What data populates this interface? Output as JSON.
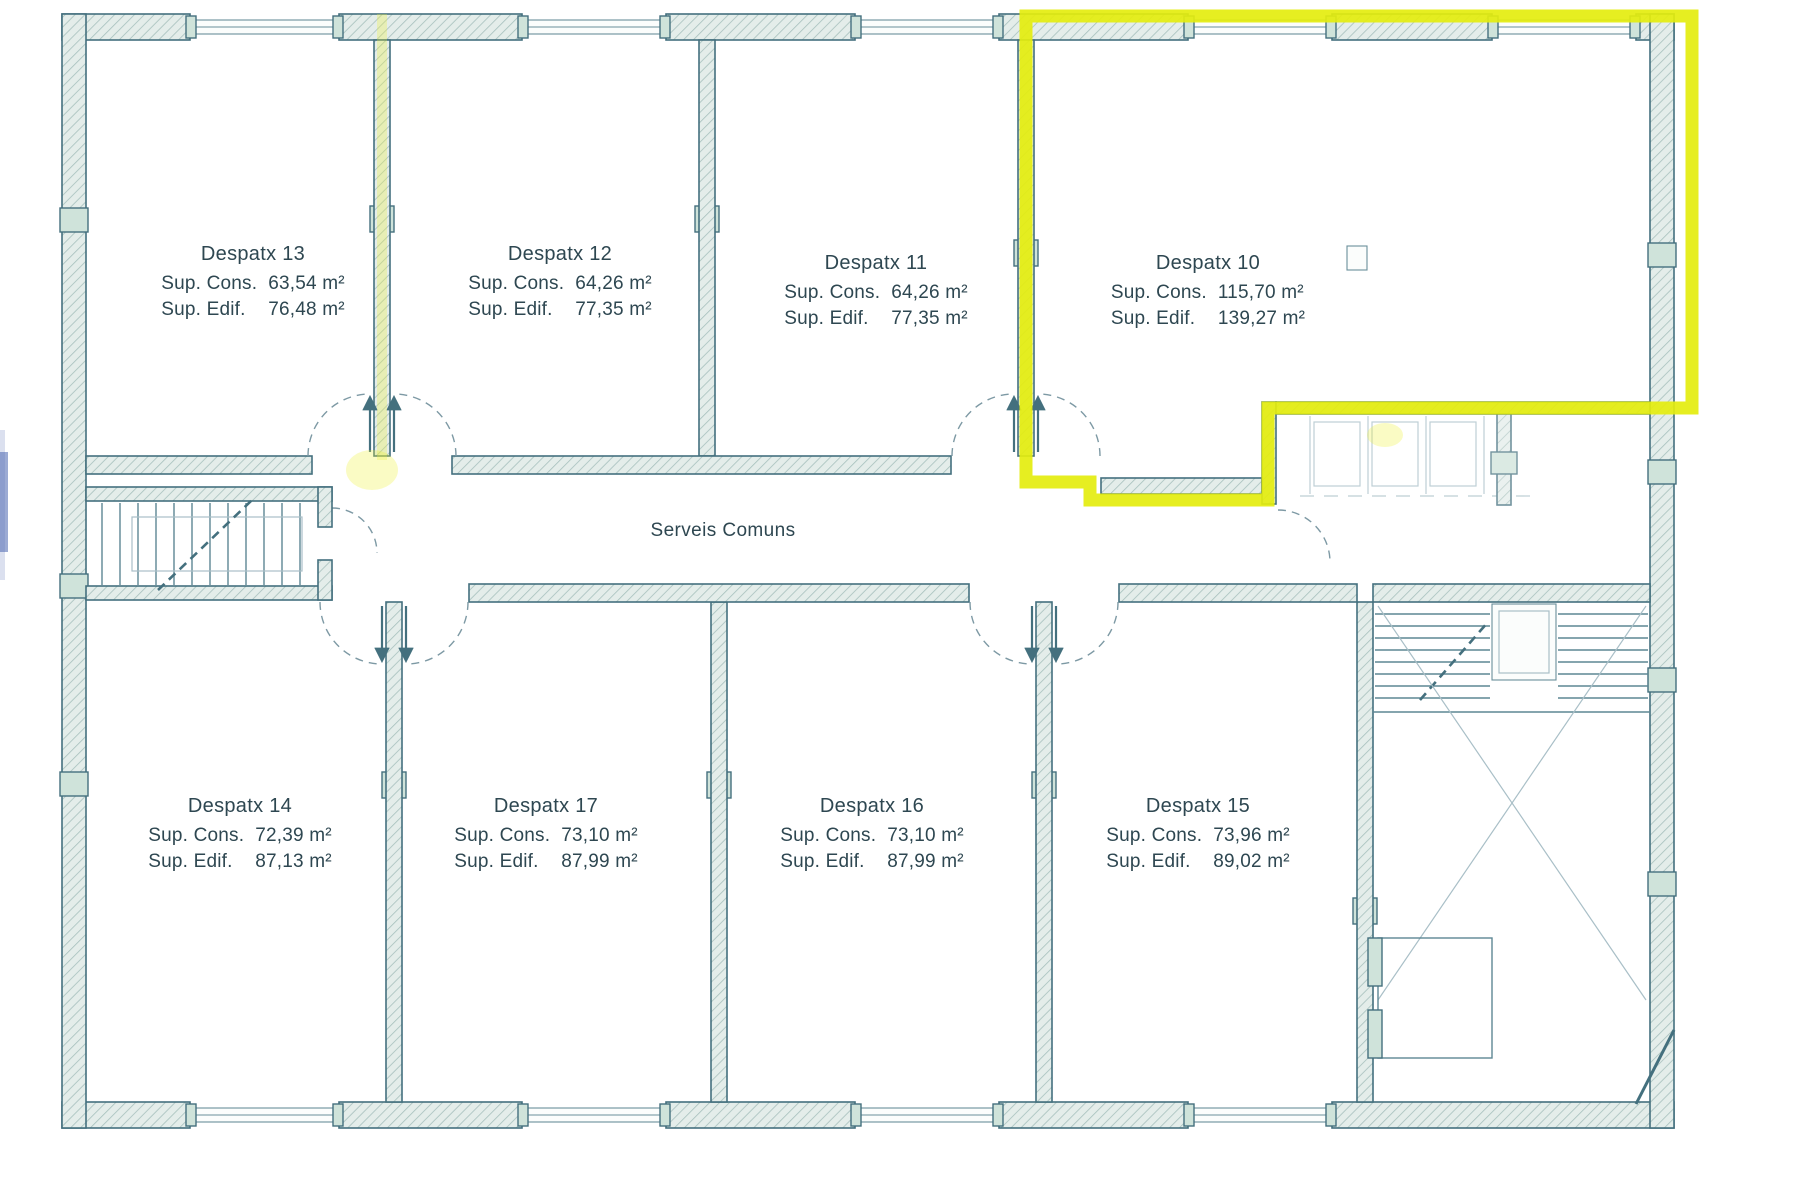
{
  "plan": {
    "corridor_label": "Serveis Comuns",
    "highlighted_room": "Despatx 10"
  },
  "colors": {
    "highlight_yellow": "#e4ed0e",
    "wall_ink": "#44707e",
    "label_text": "#2e4751"
  },
  "rooms": [
    {
      "id": "despatx-13",
      "name": "Despatx 13",
      "sup_cons_label": "Sup. Cons.",
      "sup_cons_value": "63,54 m²",
      "sup_edif_label": "Sup. Edif.",
      "sup_edif_value": "76,48 m²",
      "highlighted": false,
      "label_x": 253,
      "label_y": 243
    },
    {
      "id": "despatx-12",
      "name": "Despatx 12",
      "sup_cons_label": "Sup. Cons.",
      "sup_cons_value": "64,26 m²",
      "sup_edif_label": "Sup. Edif.",
      "sup_edif_value": "77,35 m²",
      "highlighted": false,
      "label_x": 560,
      "label_y": 243
    },
    {
      "id": "despatx-11",
      "name": "Despatx 11",
      "sup_cons_label": "Sup. Cons.",
      "sup_cons_value": "64,26 m²",
      "sup_edif_label": "Sup. Edif.",
      "sup_edif_value": "77,35 m²",
      "highlighted": false,
      "label_x": 876,
      "label_y": 252
    },
    {
      "id": "despatx-10",
      "name": "Despatx 10",
      "sup_cons_label": "Sup. Cons.",
      "sup_cons_value": "115,70 m²",
      "sup_edif_label": "Sup. Edif.",
      "sup_edif_value": "139,27 m²",
      "highlighted": true,
      "label_x": 1208,
      "label_y": 252
    },
    {
      "id": "despatx-14",
      "name": "Despatx 14",
      "sup_cons_label": "Sup. Cons.",
      "sup_cons_value": "72,39 m²",
      "sup_edif_label": "Sup. Edif.",
      "sup_edif_value": "87,13 m²",
      "highlighted": false,
      "label_x": 240,
      "label_y": 795
    },
    {
      "id": "despatx-17",
      "name": "Despatx 17",
      "sup_cons_label": "Sup. Cons.",
      "sup_cons_value": "73,10 m²",
      "sup_edif_label": "Sup. Edif.",
      "sup_edif_value": "87,99 m²",
      "highlighted": false,
      "label_x": 546,
      "label_y": 795
    },
    {
      "id": "despatx-16",
      "name": "Despatx 16",
      "sup_cons_label": "Sup. Cons.",
      "sup_cons_value": "73,10 m²",
      "sup_edif_label": "Sup. Edif.",
      "sup_edif_value": "87,99 m²",
      "highlighted": false,
      "label_x": 872,
      "label_y": 795
    },
    {
      "id": "despatx-15",
      "name": "Despatx 15",
      "sup_cons_label": "Sup. Cons.",
      "sup_cons_value": "73,96 m²",
      "sup_edif_label": "Sup. Edif.",
      "sup_edif_value": "89,02 m²",
      "highlighted": false,
      "label_x": 1198,
      "label_y": 795
    }
  ]
}
